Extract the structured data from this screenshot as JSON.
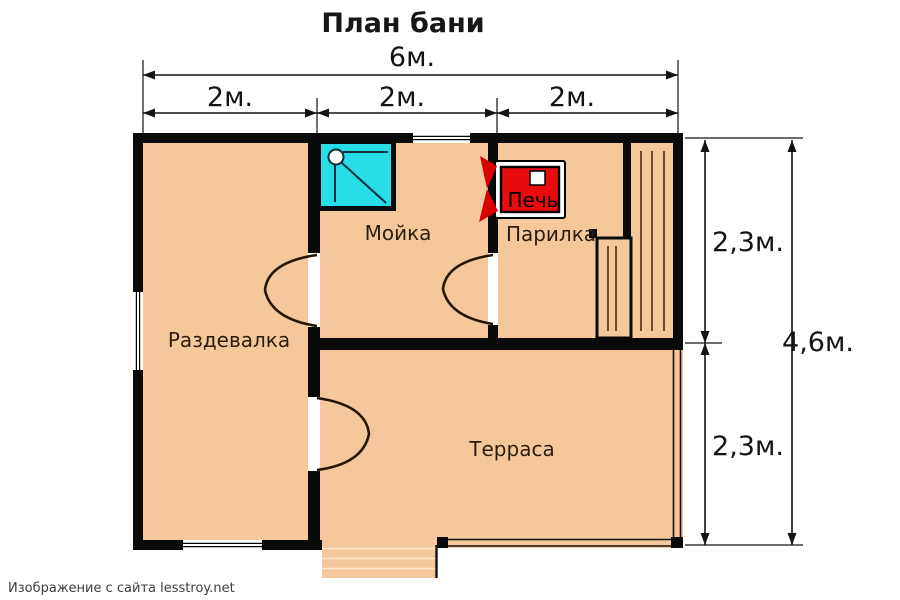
{
  "title": "План бани",
  "watermark": "Изображение с сайта lesstroy.net",
  "rooms": {
    "dressing_room": "Раздевалка",
    "washing_room": "Мойка",
    "steam_room": "Парилка",
    "terrace": "Терраса"
  },
  "stove": {
    "label": "Печь"
  },
  "dimensions": {
    "total_width": "6м.",
    "width_col_1": "2м.",
    "width_col_2": "2м.",
    "width_col_3": "2м.",
    "height_top": "2,3м.",
    "height_bottom": "2,3м.",
    "total_height": "4,6м."
  },
  "colors": {
    "floor_fill": "#F5C89B",
    "wall": "#0a0a0a",
    "shower_cyan": "#27DEE8",
    "stove_red": "#E90C0C",
    "flame_red": "#D90000",
    "plank_line": "#4a2a12"
  }
}
